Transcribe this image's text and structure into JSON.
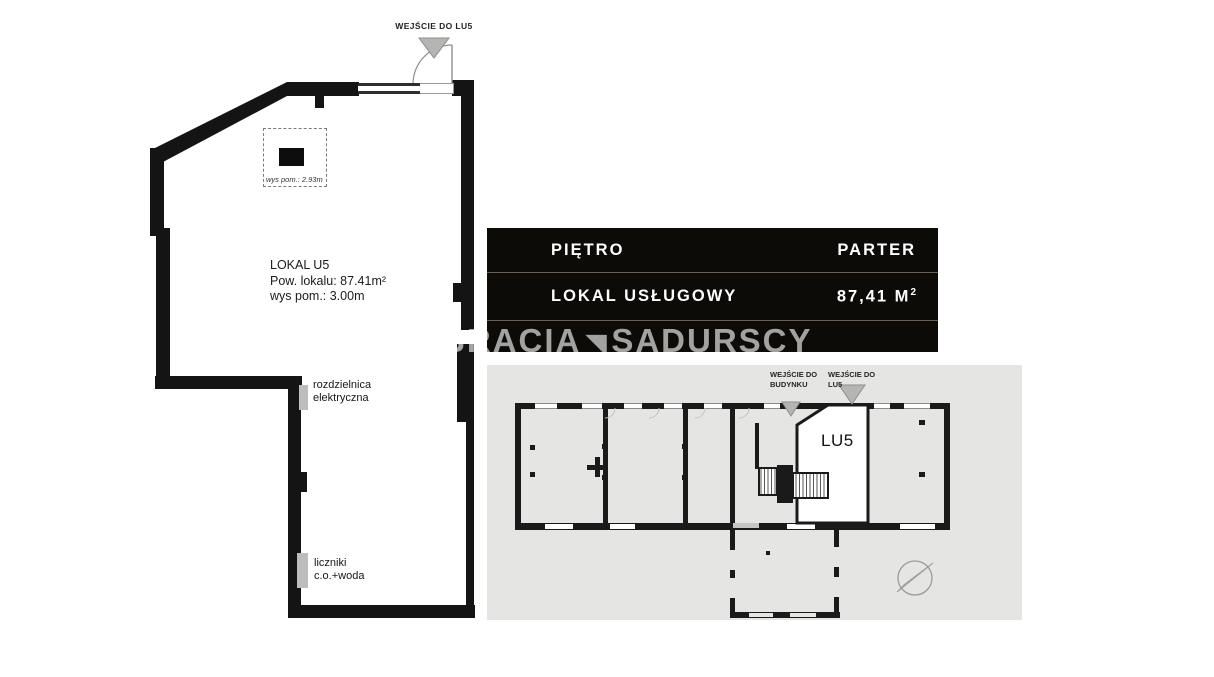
{
  "colors": {
    "wall": "#141414",
    "panel_bg": "#0d0b08",
    "panel_divider": "#6e6150",
    "panel_text": "#ffffff",
    "minimap_bg": "#e5e5e3",
    "marker_gray": "#bdbdbd",
    "entrance_triangle": "#b5b5b3",
    "watermark": "rgba(255,255,255,0.62)"
  },
  "main_plan": {
    "entrance_label": "WEJŚCIE DO LU5",
    "ceiling_box_note": "wys pom.:  2.93m",
    "unit_info": "LOKAL U5\nPow. lokalu: 87.41m²\nwys pom.: 3.00m",
    "marker_electrical": "rozdzielnica\nelektryczna",
    "marker_meters": "liczniki\nc.o.+woda"
  },
  "info_panel": {
    "rows": [
      {
        "label": "PIĘTRO",
        "value": "PARTER"
      },
      {
        "label": "LOKAL USŁUGOWY",
        "value": "87,41 M",
        "value_sup": "2"
      }
    ]
  },
  "watermark": {
    "prefix": "BRACIA",
    "mark": "◥",
    "suffix": "SADURSCY"
  },
  "minimap": {
    "entrance_building_label": "WEJŚCIE DO\nBUDYNKU",
    "entrance_unit_label": "WEJŚCIE DO\nLU5",
    "unit_label": "LU5"
  }
}
